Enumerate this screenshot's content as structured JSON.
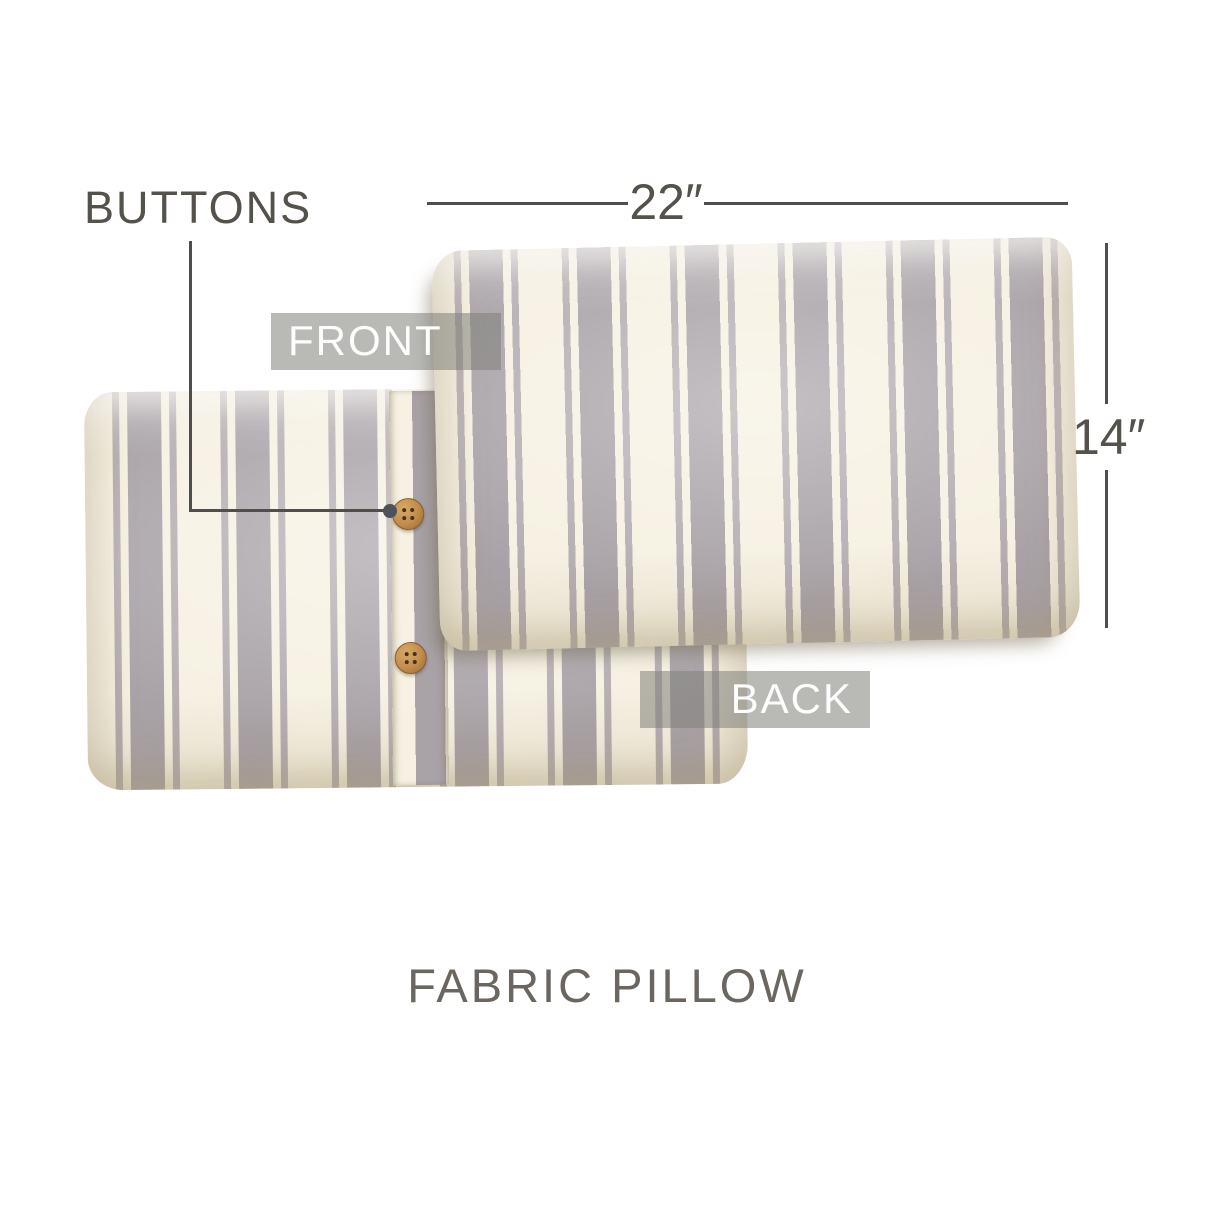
{
  "title": "FABRIC PILLOW",
  "annotations": {
    "buttons": "BUTTONS",
    "front": "FRONT",
    "back": "BACK"
  },
  "dimensions": {
    "width": "22″",
    "height": "14″"
  },
  "product": {
    "views_shown": [
      "back",
      "front"
    ],
    "button_count": 2,
    "pattern": "vertical gray grain-sack stripes on cream fabric"
  },
  "colors": {
    "bg": "#ffffff",
    "ink": "#55524c",
    "line": "#4f4e4a",
    "title_ink": "#6b6760",
    "label_bg": "rgba(128,127,122,0.55)",
    "label_text": "#fdfdfd",
    "cream": "#f6f1e2",
    "stripe_wide": "#a9a3a8",
    "stripe_thin": "#b4aeb2",
    "wood": "#c28c4c",
    "wood_dark": "#8a5e2c",
    "wood_hole": "#463218",
    "leader_dot": "#4d525c"
  }
}
